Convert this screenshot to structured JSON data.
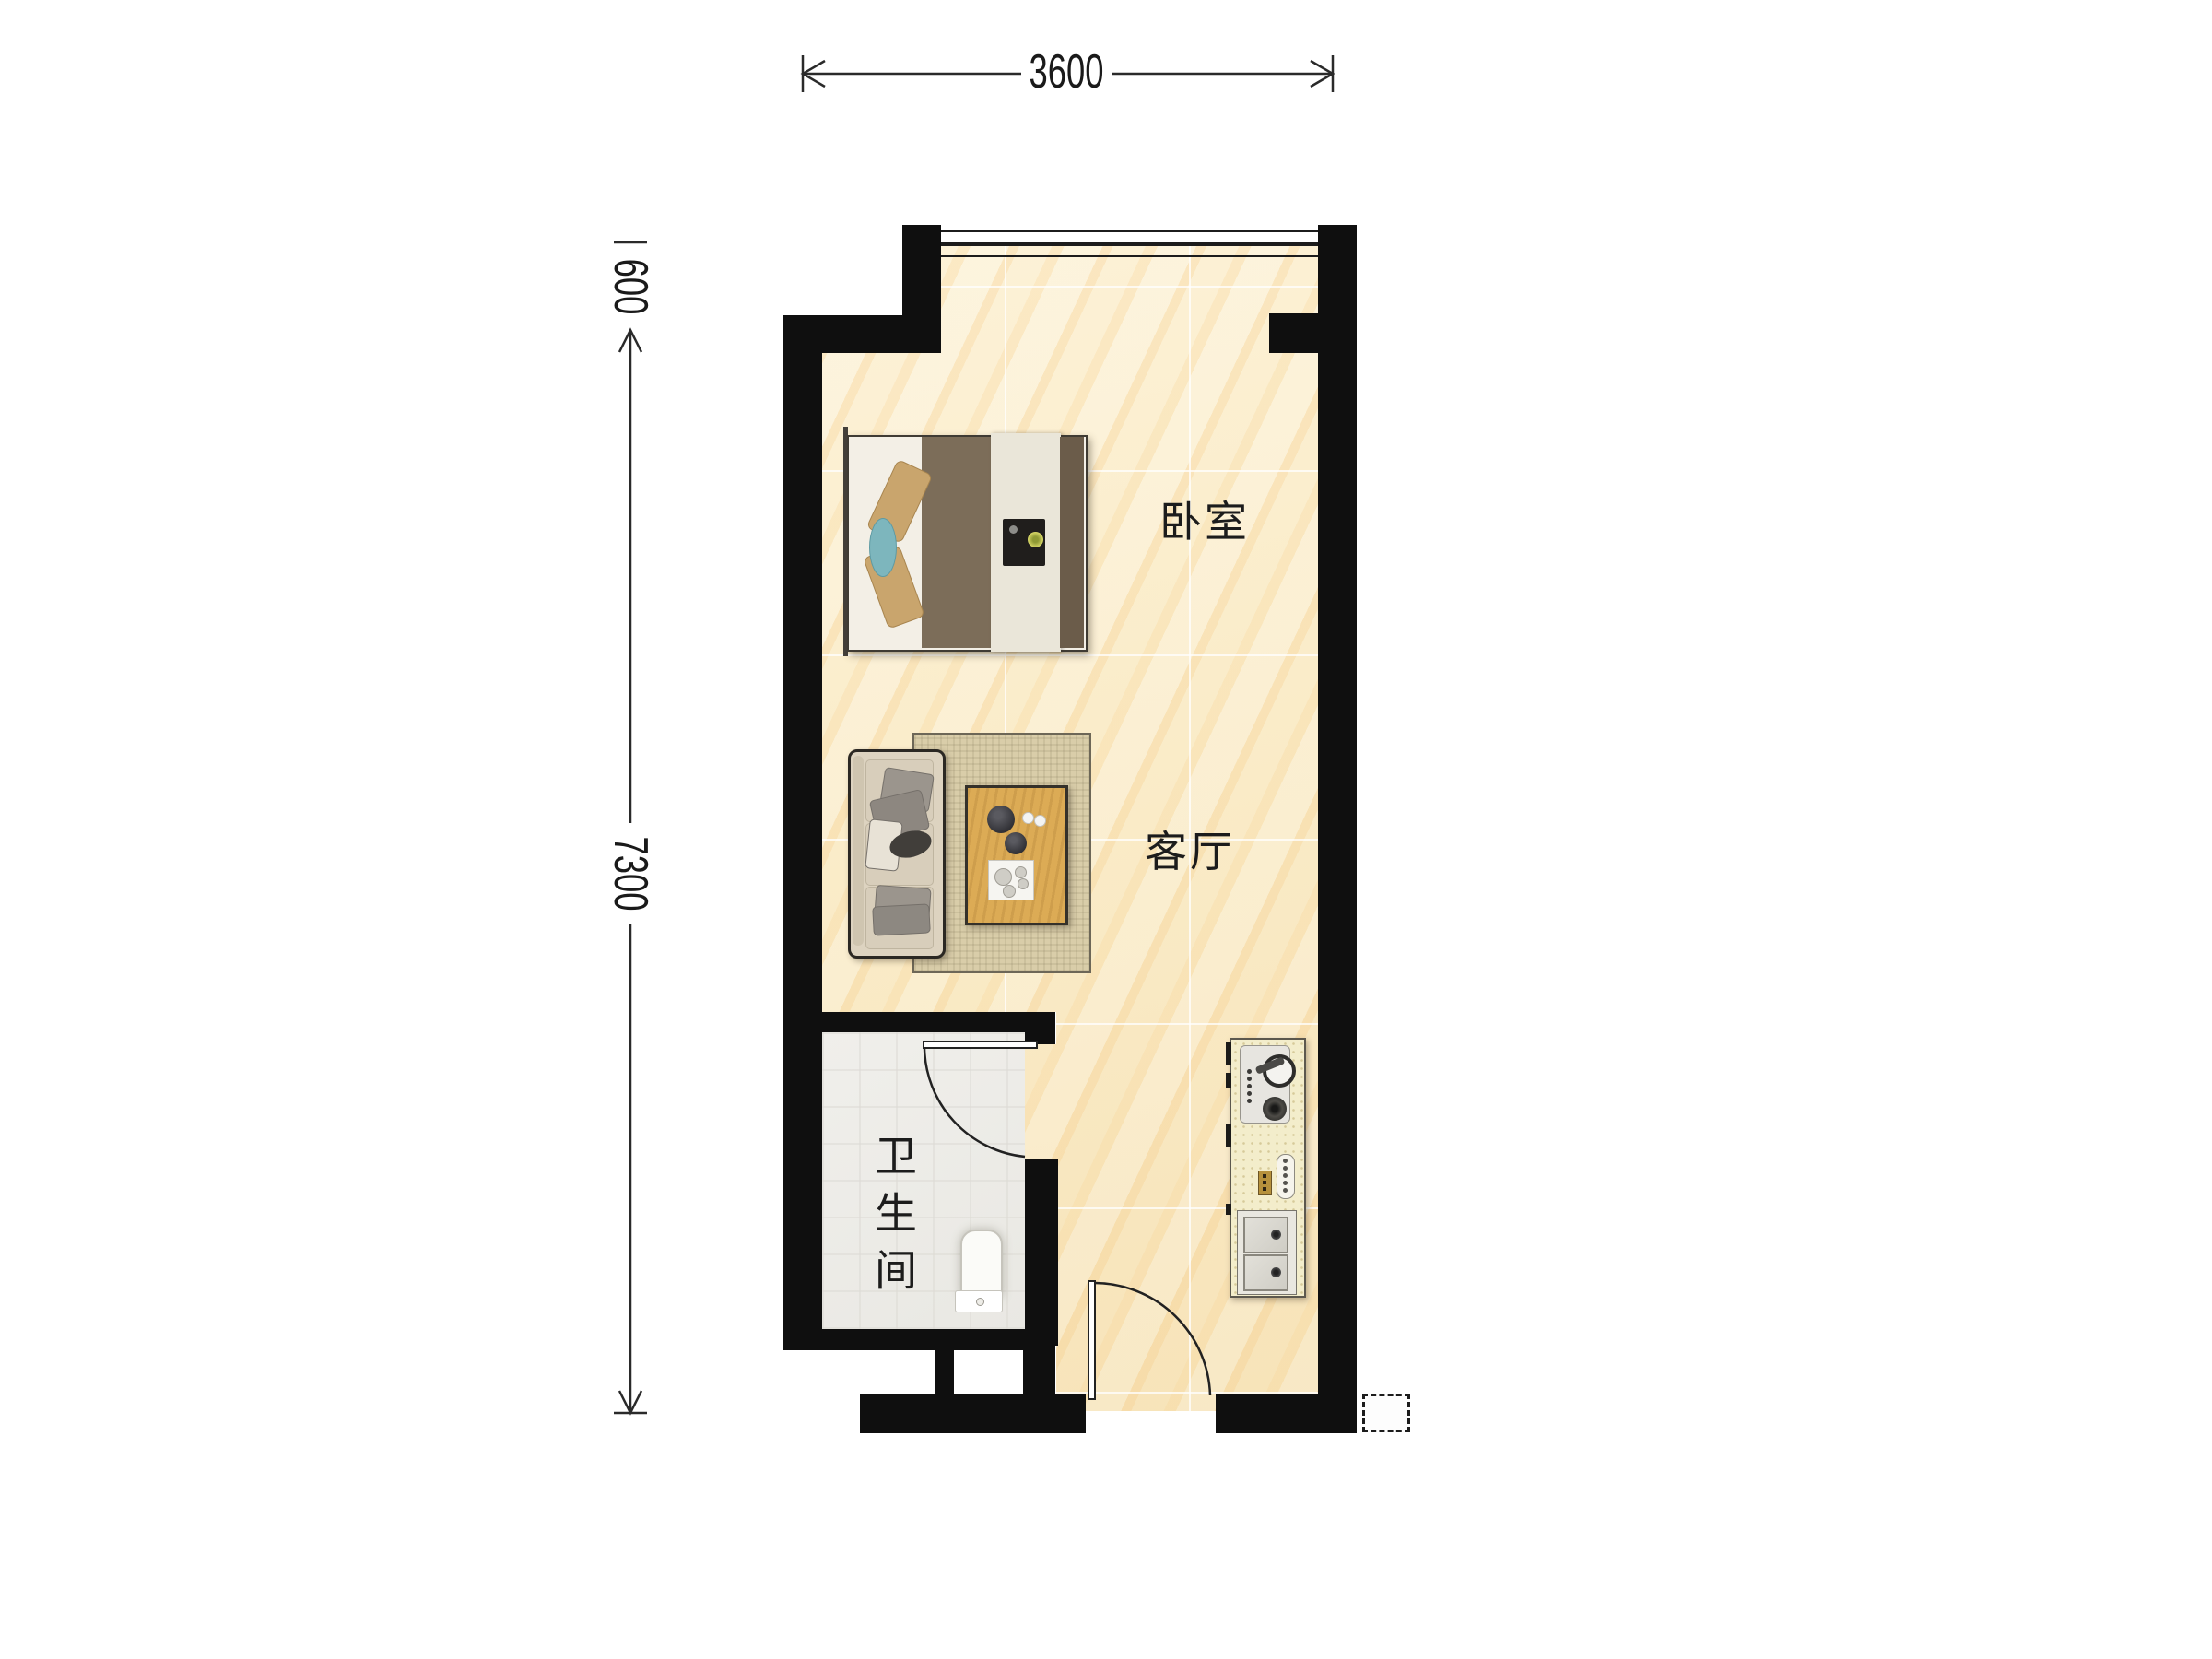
{
  "plan": {
    "type": "apartment-floor-plan",
    "dimensions": {
      "top_width_mm": "3600",
      "left_upper_mm": "600",
      "left_main_mm": "7300"
    },
    "rooms": {
      "bedroom": "卧室",
      "living_room": "客厅",
      "bathroom": "卫生间"
    },
    "furniture": [
      "double-bed",
      "sofa",
      "coffee-table",
      "rug",
      "toilet",
      "kitchen-counter",
      "gas-stove",
      "double-sink",
      "faucet"
    ],
    "openings": [
      "window-top",
      "bathroom-door",
      "entry-door"
    ],
    "colors": {
      "wall": "#0f0f0f",
      "floor_main": "#faecc9",
      "floor_bathroom": "#ecebe7",
      "rug": "#d9cda9",
      "table_wood": "#dcab55",
      "bed_duvet": "#7c6d59",
      "pillow_tan": "#c9a56d",
      "accent_teal": "#7db6bd",
      "counter": "#f3edcb",
      "annotation": "#1a1a1a"
    }
  }
}
